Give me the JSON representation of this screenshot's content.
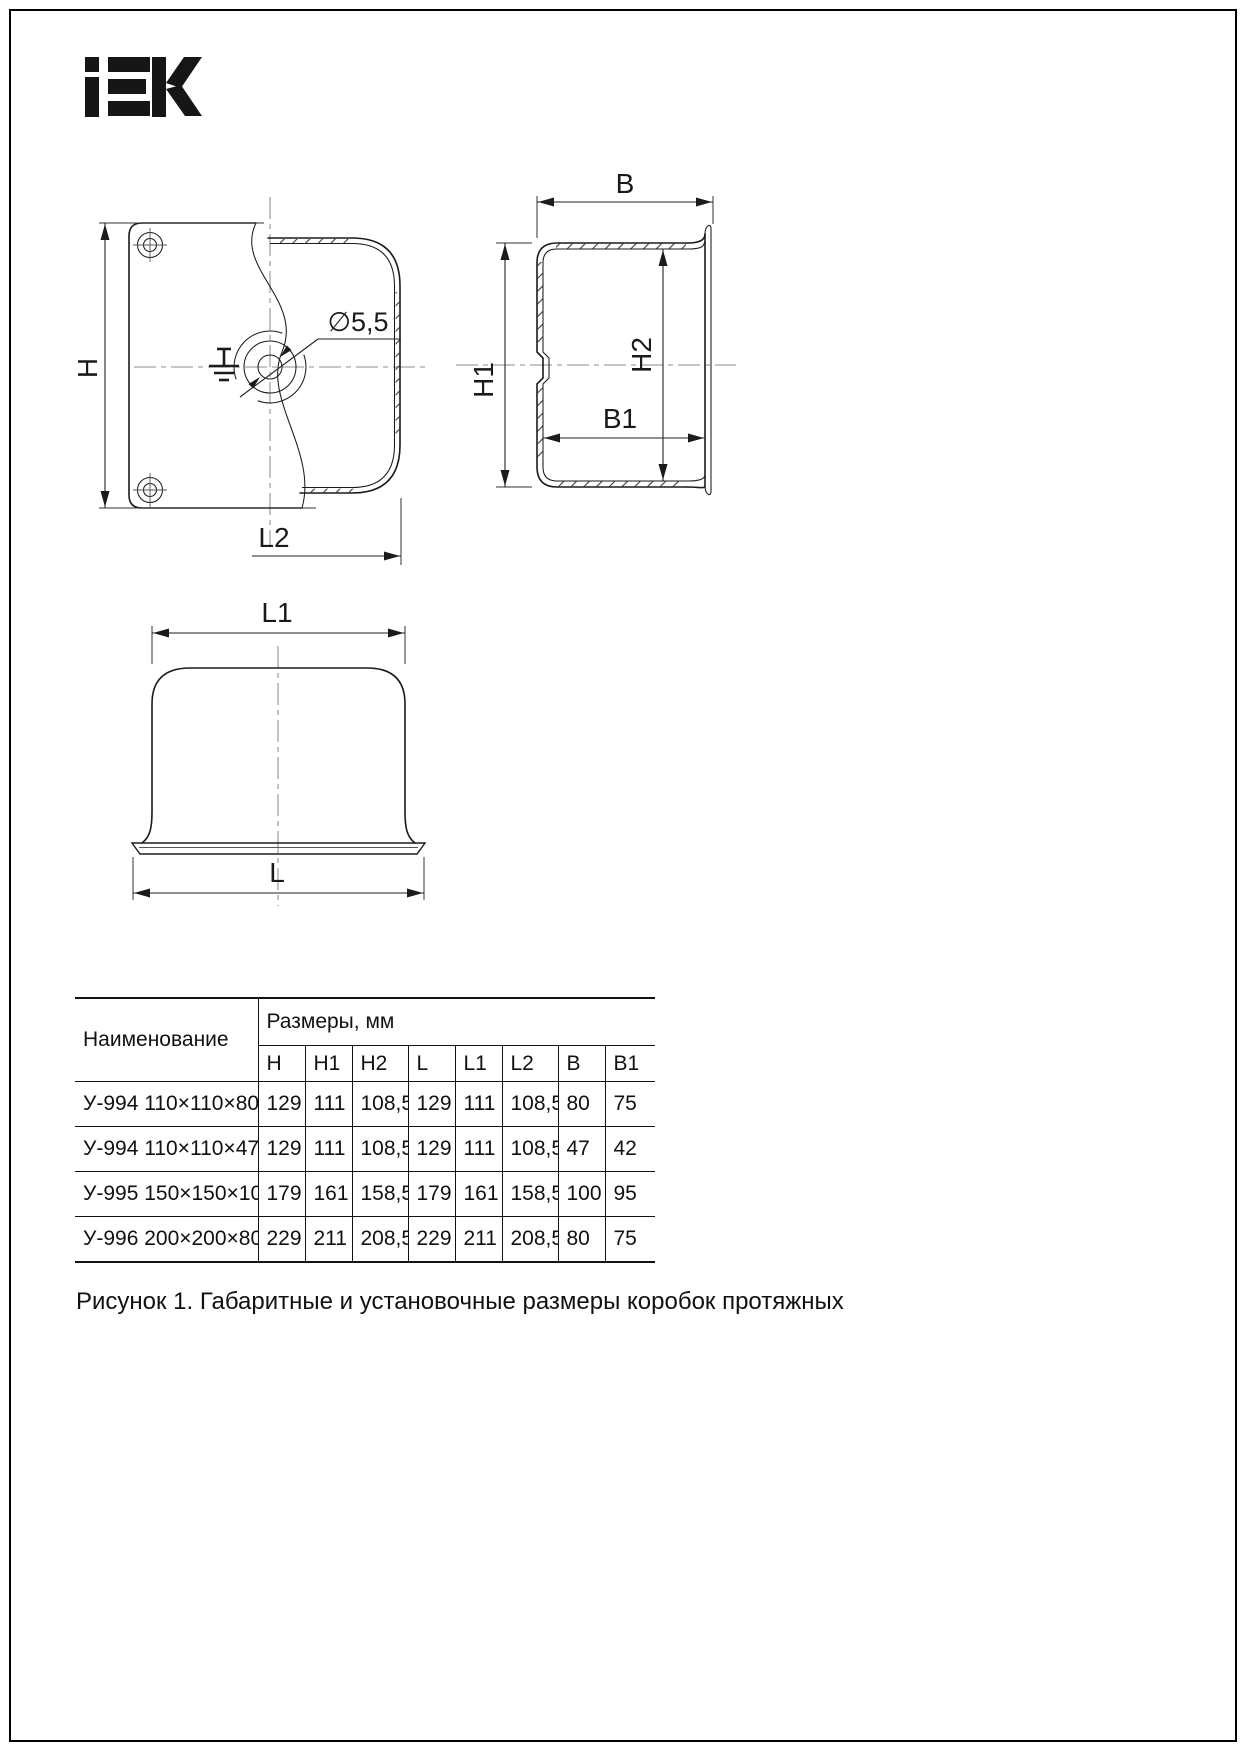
{
  "logo": {
    "brand": "IEK"
  },
  "figure": {
    "caption": "Рисунок 1. Габаритные и установочные размеры коробок протяжных"
  },
  "drawings": {
    "front_view": {
      "dim_h": "H",
      "dim_l2": "L2",
      "hole_callout": "∅5,5"
    },
    "side_view": {
      "dim_b": "B",
      "dim_h1": "H1",
      "dim_h2": "H2",
      "dim_b1": "B1"
    },
    "bottom_view": {
      "dim_l1": "L1",
      "dim_l": "L"
    }
  },
  "table": {
    "name_header": "Наименование",
    "group_header": "Размеры, мм",
    "dim_headers": [
      "H",
      "H1",
      "H2",
      "L",
      "L1",
      "L2",
      "B",
      "B1"
    ],
    "rows": [
      {
        "name": "У-994 110×110×80",
        "values": [
          "129",
          "111",
          "108,5",
          "129",
          "111",
          "108,5",
          "80",
          "75"
        ]
      },
      {
        "name": "У-994 110×110×47",
        "values": [
          "129",
          "111",
          "108,5",
          "129",
          "111",
          "108,5",
          "47",
          "42"
        ]
      },
      {
        "name": "У-995 150×150×100",
        "values": [
          "179",
          "161",
          "158,5",
          "179",
          "161",
          "158,5",
          "100",
          "95"
        ]
      },
      {
        "name": "У-996 200×200×80",
        "values": [
          "229",
          "211",
          "208,5",
          "229",
          "211",
          "208,5",
          "80",
          "75"
        ]
      }
    ]
  },
  "colors": {
    "ink": "#1a1a1a",
    "centerline": "#8c8c8c",
    "background": "#ffffff"
  }
}
